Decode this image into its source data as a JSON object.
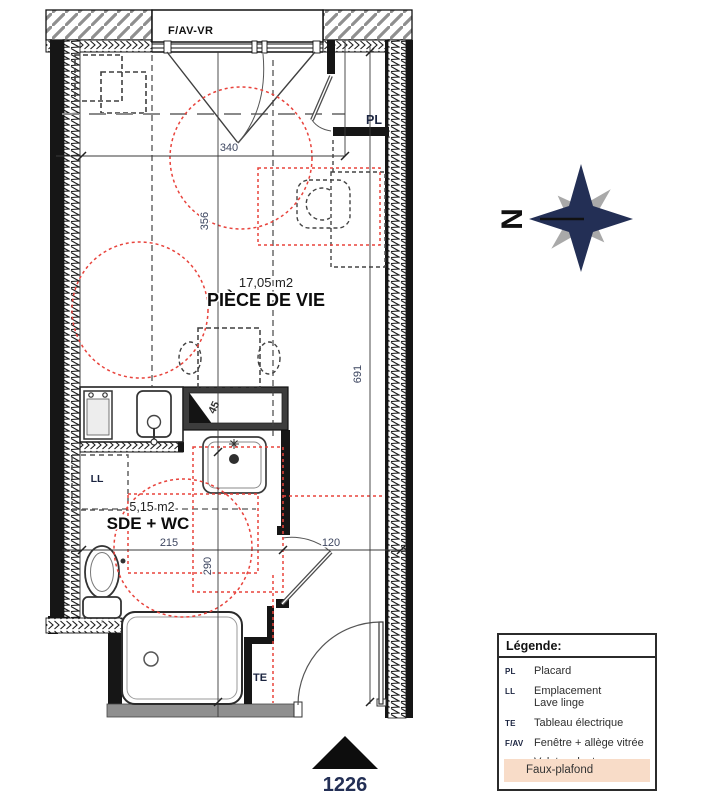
{
  "plan": {
    "window_label": "F/AV-VR",
    "living": {
      "name": "PIÈCE DE VIE",
      "area": "17,05 m2"
    },
    "bathroom": {
      "name": "SDE + WC",
      "area": "5,15 m2"
    },
    "tags": {
      "placard": "PL",
      "lave_linge": "LL",
      "tableau": "TE"
    },
    "dims": {
      "width_340": "340",
      "height_356": "356",
      "height_691": "691",
      "duct_45": "45",
      "sde_width_215": "215",
      "sde_height_290": "290",
      "hall_120": "120"
    },
    "lot_number": "1226"
  },
  "compass": {
    "north": "N"
  },
  "legend": {
    "title": "Légende:",
    "entries": [
      {
        "abbr": "PL",
        "label": "Placard"
      },
      {
        "abbr": "LL",
        "label": "Emplacement",
        "label2": "Lave linge"
      },
      {
        "abbr": "TE",
        "label": "Tableau électrique"
      },
      {
        "abbr": "F/AV",
        "label": "Fenêtre + allège vitrée"
      },
      {
        "abbr": "VR",
        "label": "Volet roulant"
      }
    ],
    "faux_plafond": "Faux-plafond"
  },
  "colors": {
    "accent_red": "#e8433c",
    "navy": "#232f55",
    "faux_plafond_fill": "#f8dcc8",
    "wall_black": "#161616",
    "hatch_gray": "#8f8f8f",
    "slab_gray": "#8f8f8f"
  }
}
